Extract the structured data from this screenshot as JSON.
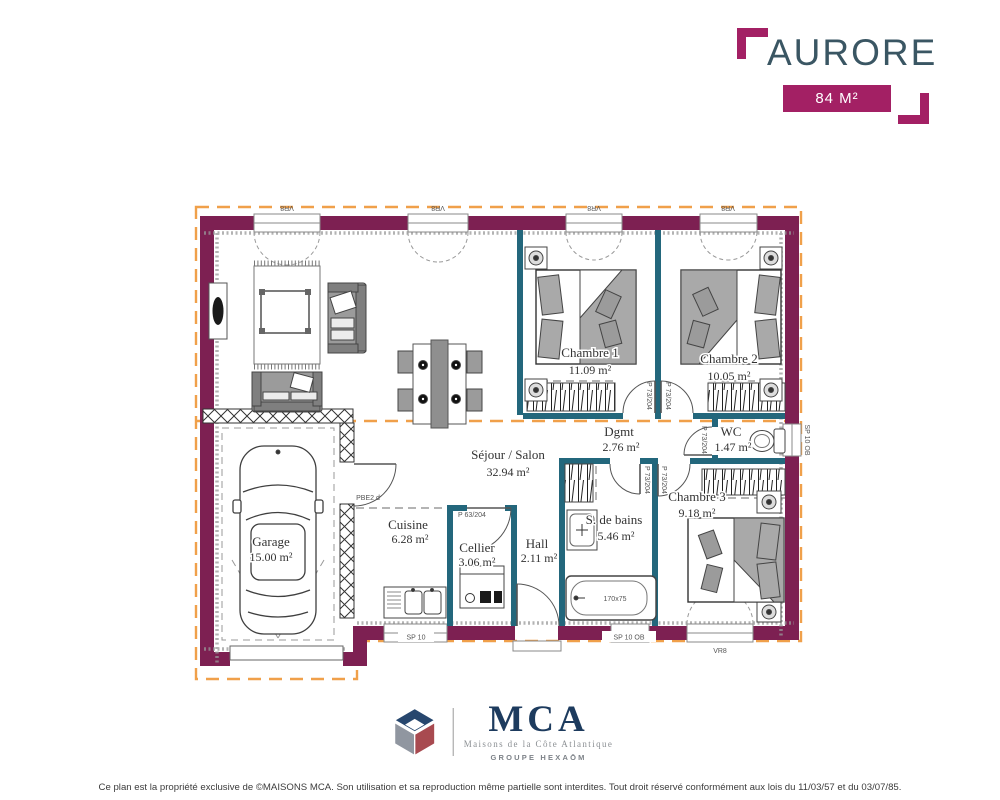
{
  "header": {
    "title": "AURORE",
    "area_badge": "84 M²"
  },
  "plan": {
    "rooms": {
      "sejour": {
        "name": "Séjour / Salon",
        "area": "32.94 m²"
      },
      "cuisine": {
        "name": "Cuisine",
        "area": "6.28 m²"
      },
      "cellier": {
        "name": "Cellier",
        "area": "3.06 m²"
      },
      "hall": {
        "name": "Hall",
        "area": "2.11 m²"
      },
      "garage": {
        "name": "Garage",
        "area": "15.00 m²"
      },
      "chambre1": {
        "name": "Chambre 1",
        "area": "11.09 m²"
      },
      "chambre2": {
        "name": "Chambre 2",
        "area": "10.05 m²"
      },
      "chambre3": {
        "name": "Chambre 3",
        "area": "9.18 m²"
      },
      "dgmt": {
        "name": "Dgmt",
        "area": "2.76 m²"
      },
      "wc": {
        "name": "WC",
        "area": "1.47 m²"
      },
      "sdb": {
        "name": "S. de bains",
        "area": "5.46 m²"
      }
    },
    "labels": {
      "window_vr8": "VR8",
      "window_sp10": "SP 10",
      "window_sp10ob": "SP 10 OB",
      "door_p73": "P 73/204",
      "door_p63": "P 63/204",
      "door_garage": "PBE2 d",
      "bathtub": "170x75"
    }
  },
  "footer": {
    "logo_text": "MCA",
    "logo_subtitle": "Maisons de la Côte Atlantique",
    "logo_group": "GROUPE HEXAŌM",
    "disclaimer": "Ce plan est la propriété exclusive de ©MAISONS MCA. Son utilisation et sa reproduction même partielle sont interdites. Tout droit réservé conformément aux lois du 11/03/57 et du 03/07/85."
  },
  "colors": {
    "wall": "#7d2052",
    "partition": "#23677c",
    "brand_magenta": "#a32064",
    "title_teal": "#3a5663",
    "roof_line": "#f0a04a",
    "mca_navy": "#1d3b5e"
  }
}
